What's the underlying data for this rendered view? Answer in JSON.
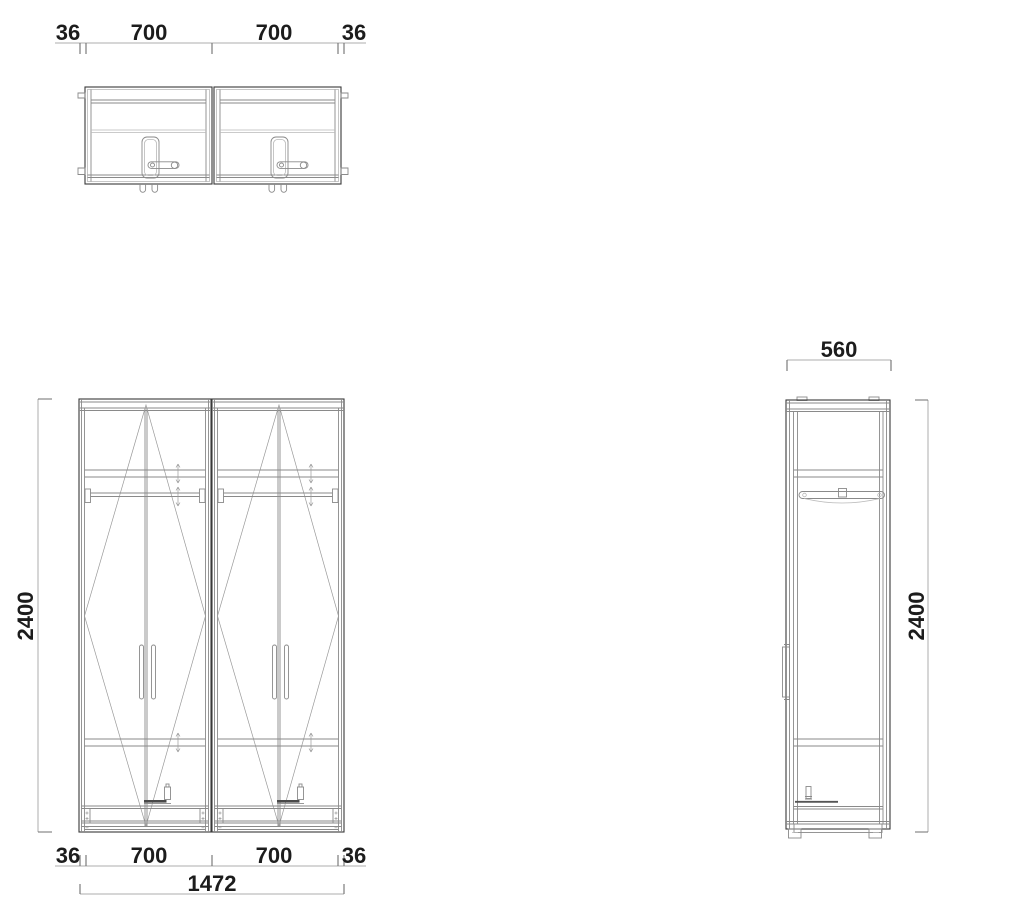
{
  "drawing": {
    "background": "#ffffff",
    "line_color": "#3a3a3a",
    "secondary_line_color": "#8a8a8a",
    "dimension_line_color": "#adadad",
    "text_color": "#1c1c1c",
    "views": {
      "plan": {
        "dim_left_side_panel": "36",
        "dim_left_bay": "700",
        "dim_right_bay": "700",
        "dim_right_side_panel": "36"
      },
      "front": {
        "dim_height": "2400",
        "dim_left_side_panel": "36",
        "dim_left_bay": "700",
        "dim_right_bay": "700",
        "dim_right_side_panel": "36",
        "dim_total_width": "1472"
      },
      "side": {
        "dim_depth": "560",
        "dim_height": "2400"
      }
    }
  }
}
